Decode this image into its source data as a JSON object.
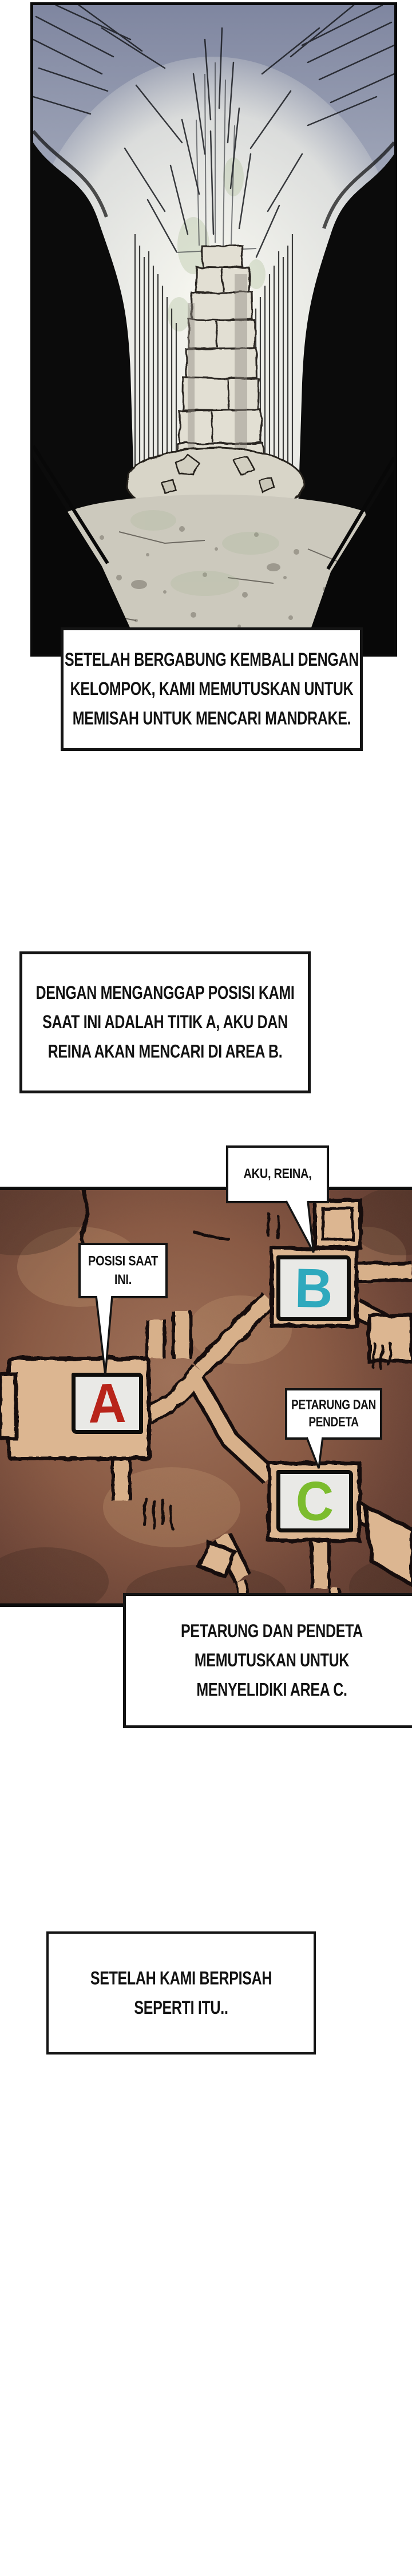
{
  "boxes": {
    "box1": {
      "lines": [
        "SETELAH BERGABUNG KEMBALI DENGAN",
        "KELOMPOK, KAMI MEMUTUSKAN UNTUK",
        "MEMISAH UNTUK MENCARI MANDRAKE."
      ]
    },
    "box2": {
      "lines": [
        "DENGAN MENGANGGAP POSISI KAMI",
        "SAAT INI ADALAH TITIK A, AKU DAN",
        "REINA AKAN MENCARI DI AREA B."
      ]
    },
    "box3": {
      "lines": [
        "PETARUNG DAN PENDETA",
        "MEMUTUSKAN UNTUK",
        "MENYELIDIKI AREA C."
      ]
    },
    "box4": {
      "lines": [
        "SETELAH KAMI BERPISAH",
        "SEPERTI ITU.."
      ]
    }
  },
  "map": {
    "callouts": {
      "aku_reina": {
        "lines": [
          "AKU, REINA,"
        ]
      },
      "posisi": {
        "lines": [
          "POSISI SAAT",
          "INI."
        ]
      },
      "petarung": {
        "lines": [
          "PETARUNG DAN",
          "PENDETA"
        ]
      }
    },
    "markers": {
      "a": {
        "letter": "A",
        "color": "#b8241a"
      },
      "b": {
        "letter": "B",
        "color": "#2fa9bd"
      },
      "c": {
        "letter": "C",
        "color": "#7cbc2e"
      }
    },
    "palette": {
      "ground_dark": "#57362b",
      "ground_mid": "#8a5a44",
      "path_tan": "#d7b08a",
      "ink": "#15100b"
    }
  }
}
